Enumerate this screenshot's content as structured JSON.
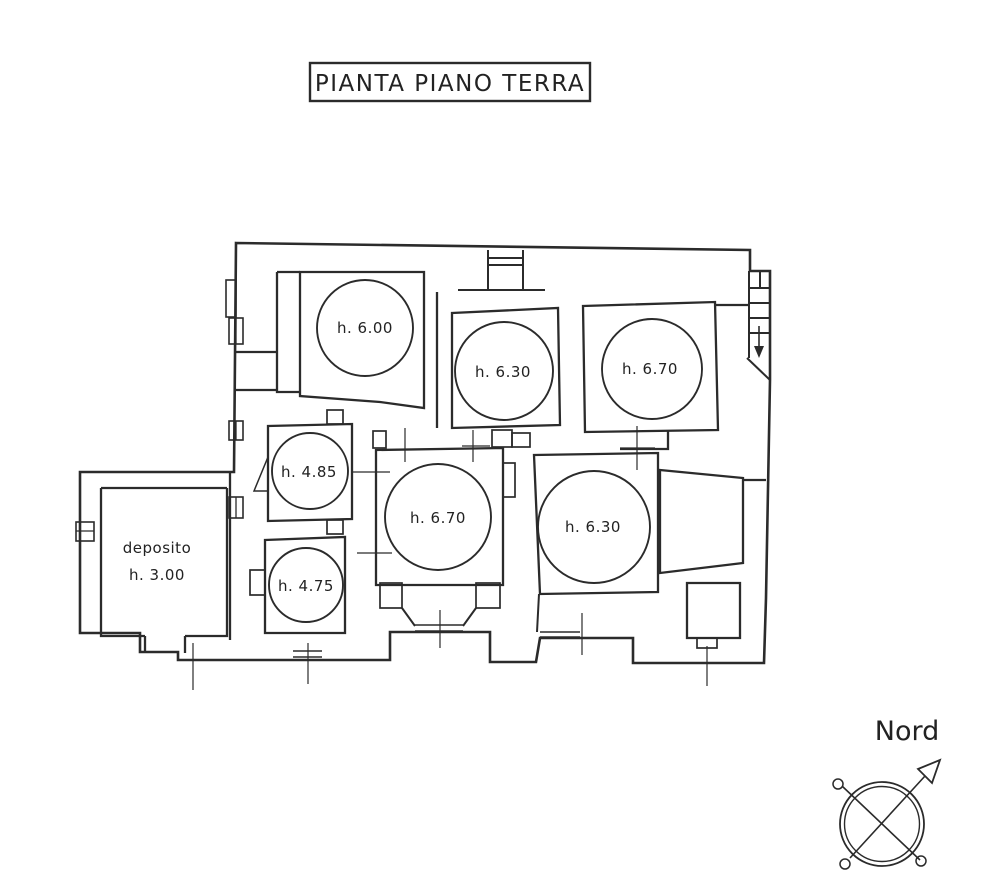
{
  "title": {
    "text": "PIANTA PIANO TERRA"
  },
  "plan": {
    "rooms": [
      {
        "label": "h. 6.00"
      },
      {
        "label": "h. 6.30"
      },
      {
        "label": "h. 6.70"
      },
      {
        "label": "h. 4.85"
      },
      {
        "label": "h. 6.70"
      },
      {
        "label": "h. 6.30"
      },
      {
        "label": "h. 4.75"
      }
    ],
    "deposito": {
      "name": "deposito",
      "height": "h. 3.00"
    }
  },
  "compass": {
    "label": "Nord"
  },
  "colors": {
    "ink": "#2b2b2b",
    "background": "#ffffff"
  }
}
